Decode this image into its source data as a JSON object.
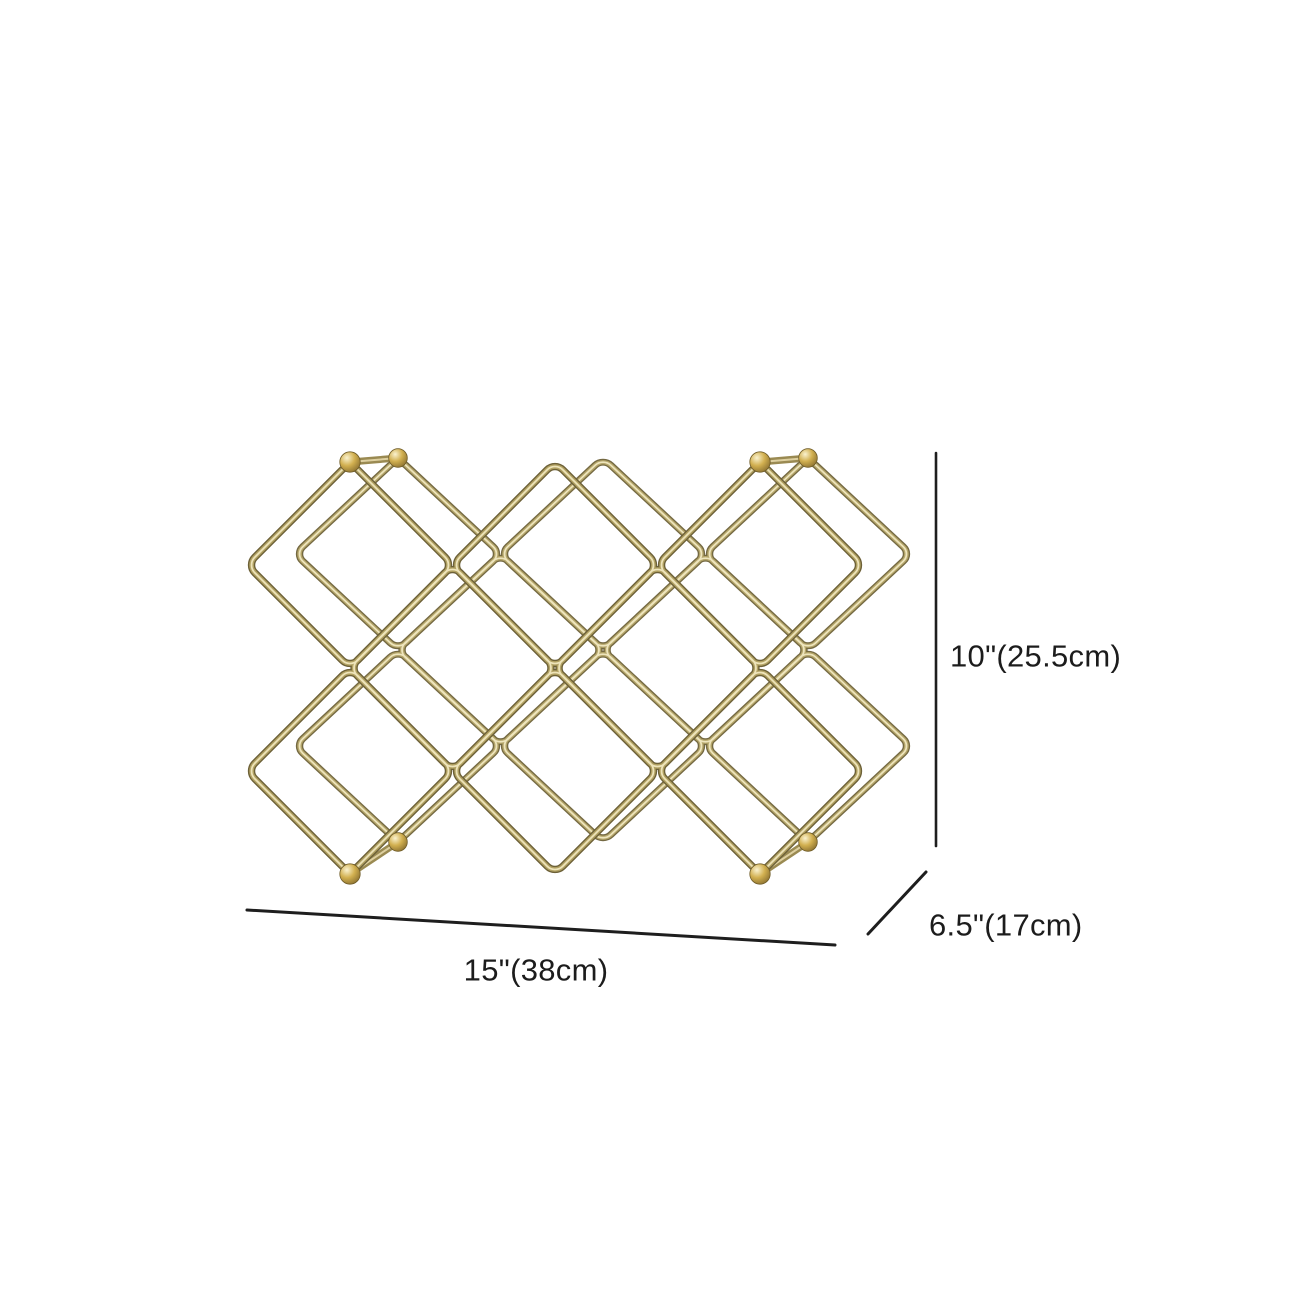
{
  "figure": {
    "subject": "gold criss-cross accordion wine rack"
  },
  "dimensions": {
    "height_label": "10\"(25.5cm)",
    "width_label": "15\"(38cm)",
    "depth_label": "6.5\"(17cm)"
  },
  "colors": {
    "background": "#ffffff",
    "dimension_line": "#1e1e1e",
    "label_text": "#1c1c1c",
    "wire_gold_dark": "#6d6138",
    "wire_gold_mid": "#b2a263",
    "wire_gold_highlight": "#eee4ba",
    "pivot_ball_gold": "#d2b050"
  }
}
